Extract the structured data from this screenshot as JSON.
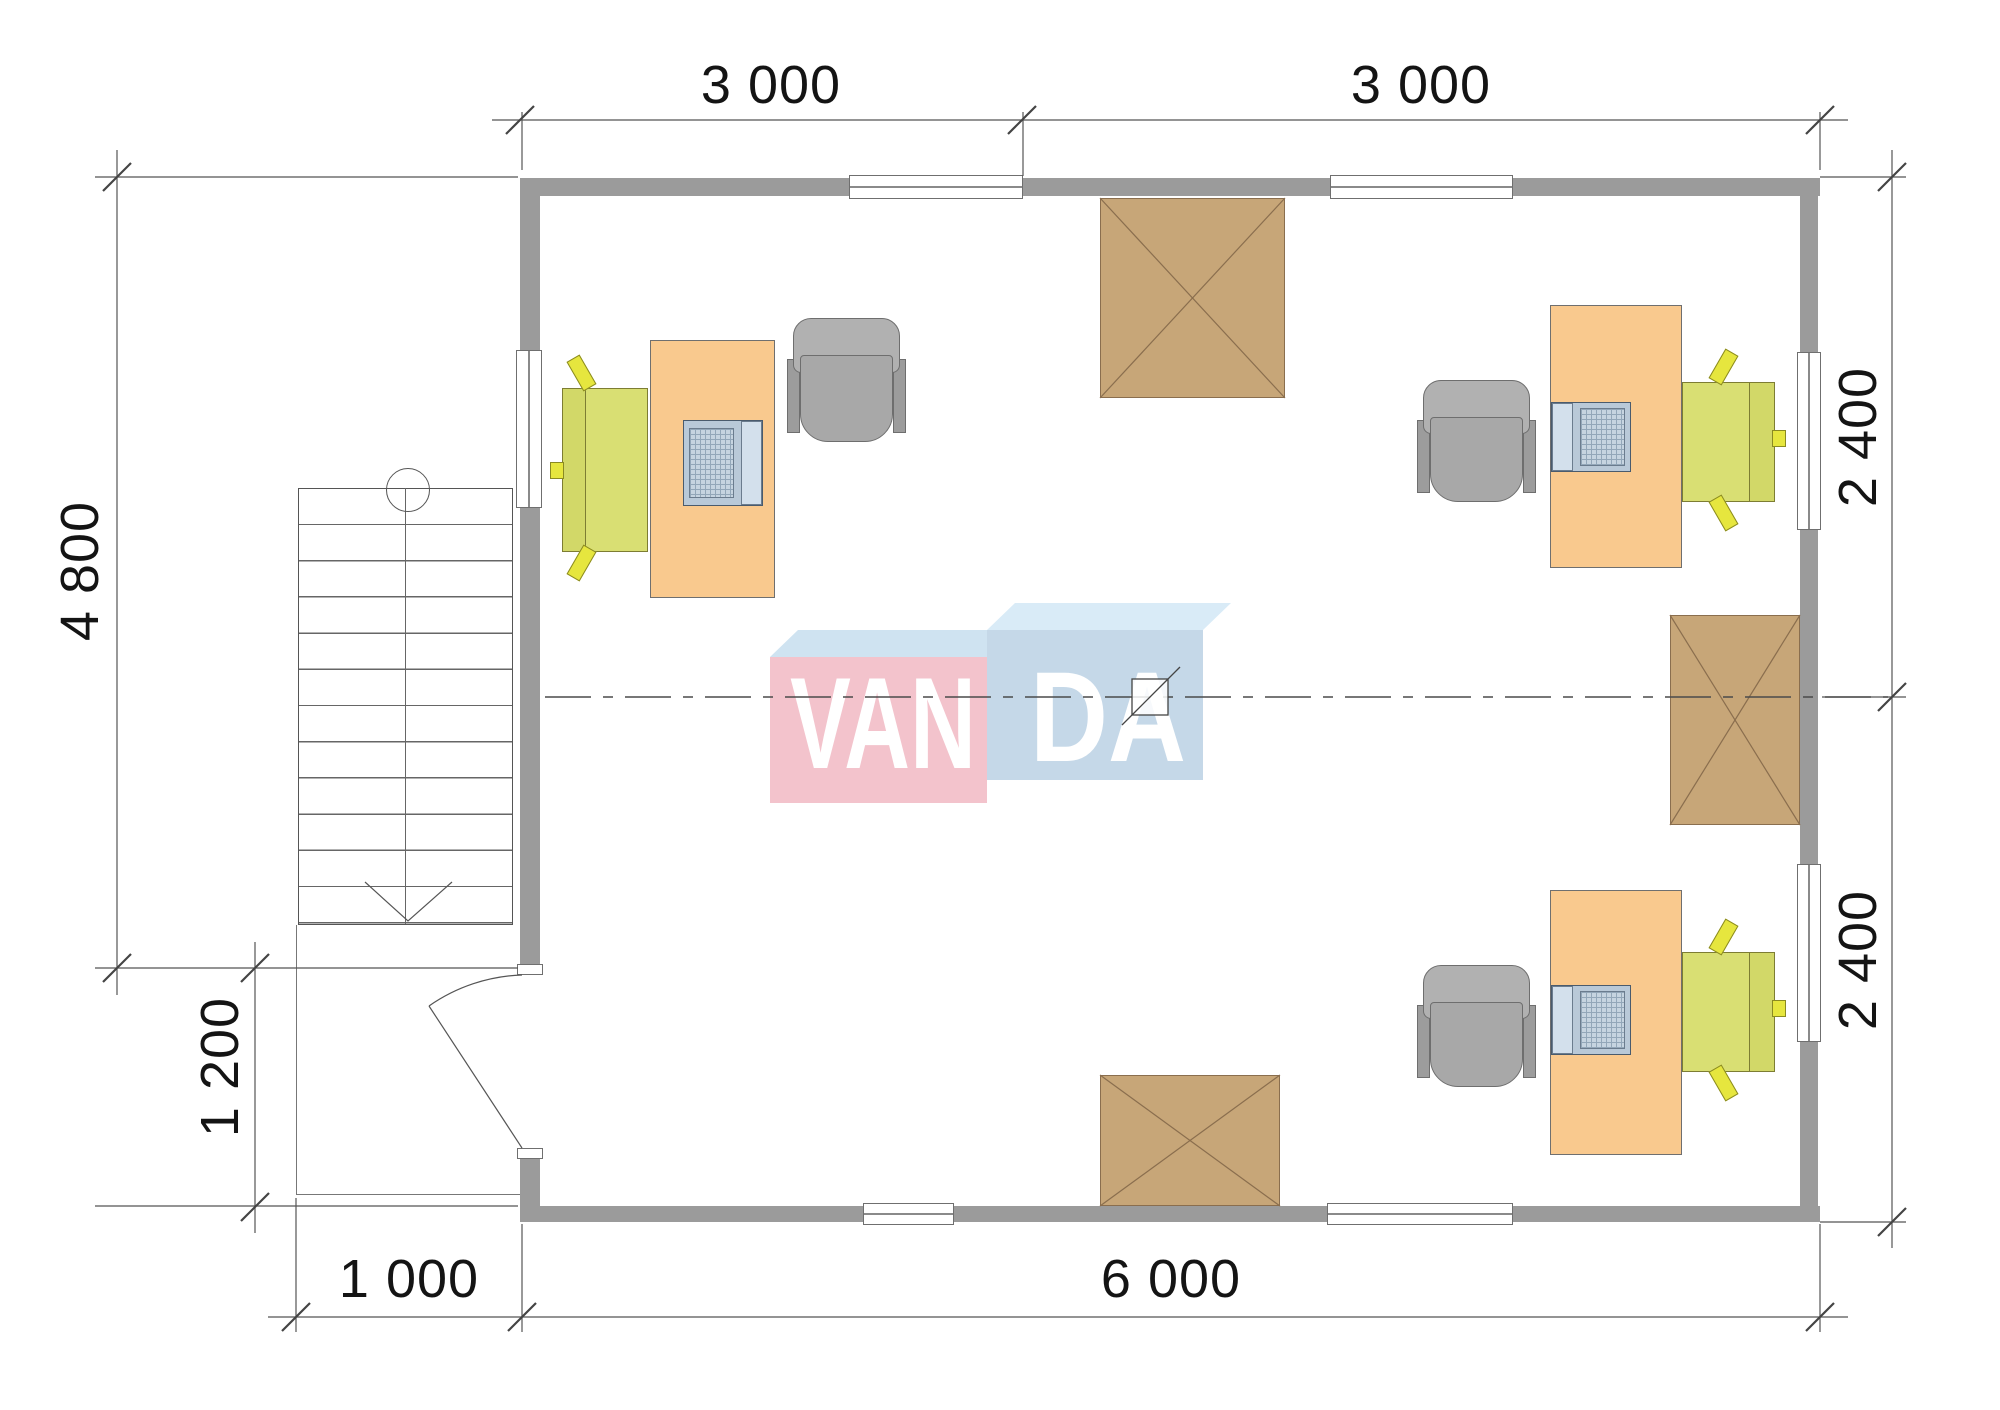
{
  "document": {
    "type": "architectural floor plan"
  },
  "watermark": {
    "left_text": "VAN",
    "right_text": "DA"
  },
  "dimensions": {
    "top": [
      {
        "label": "3 000"
      },
      {
        "label": "3 000"
      }
    ],
    "bottom": [
      {
        "label": "1 000"
      },
      {
        "label": "6 000"
      }
    ],
    "left": [
      {
        "label": "4 800"
      },
      {
        "label": "1 200"
      }
    ],
    "right": [
      {
        "label": "2 400"
      },
      {
        "label": "2 400"
      }
    ]
  },
  "colors": {
    "wall": "#9b9b9b",
    "desk": "#f9c98e",
    "office_chair": "#ababab",
    "armchair_green": "#d9df73",
    "armchair_accent": "#e6e63e",
    "hatch_brown": "#c7a678",
    "hatch_line": "#8a6e4e",
    "logo_pink": "#f3c3cc",
    "logo_blue": "#c5d8e8",
    "logo_top_face": "#d5e7f4",
    "dimension_text": "#141414",
    "drawing_line": "#555555"
  }
}
